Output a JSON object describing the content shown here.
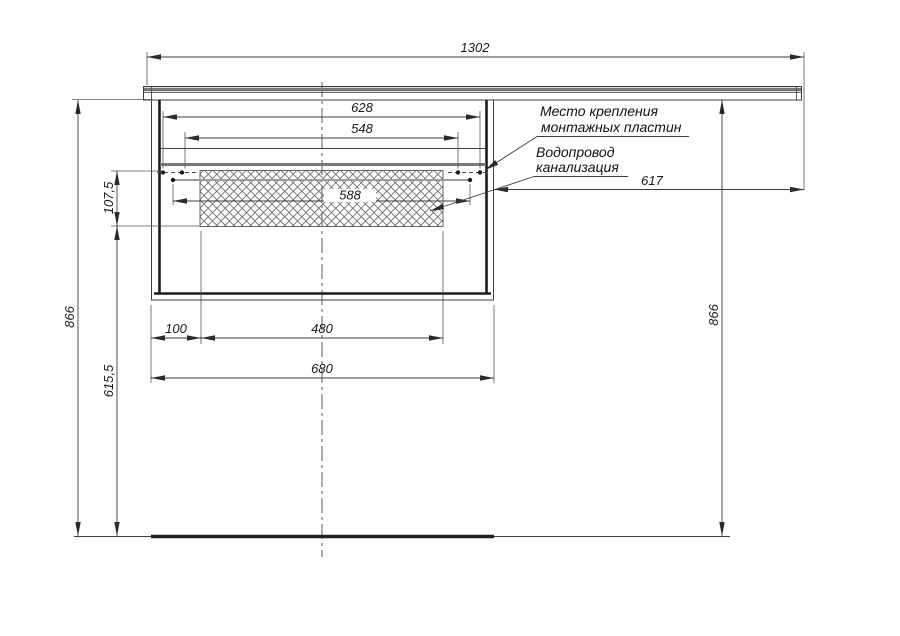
{
  "drawing": {
    "type": "installation-drawing",
    "dimensions": {
      "countertop_width": "1302",
      "mounting_outer_width": "628",
      "mounting_inner_width": "548",
      "mounting_mid_width": "588",
      "right_countertop_overhang": "617",
      "overall_height_left": "866",
      "overall_height_right": "866",
      "plumbing_zone_height": "107,5",
      "clearance_under_zone": "615,5",
      "side_inset": "100",
      "plumbing_zone_width": "480",
      "cabinet_width": "680"
    },
    "labels": {
      "mounting_plates": [
        "Место крепления",
        "монтажных пластин"
      ],
      "plumbing": [
        "Водопровод",
        "канализация"
      ]
    },
    "colors": {
      "line": "#3f3f3f",
      "thick_line": "#1c1c1c",
      "gray_line": "#787878",
      "hatch": "#6a6a6a",
      "background": "#ffffff"
    }
  }
}
